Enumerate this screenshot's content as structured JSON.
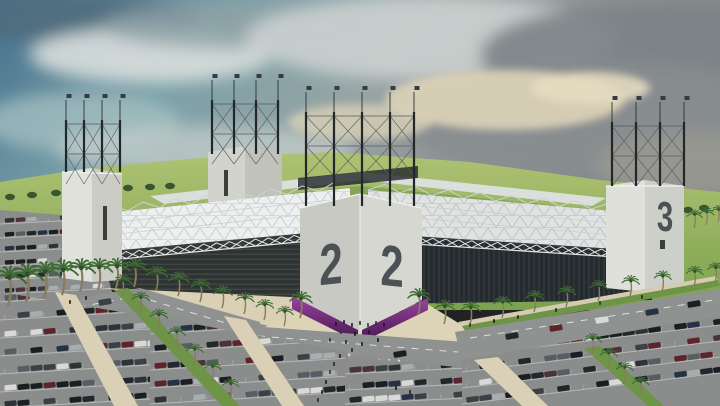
{
  "meta": {
    "description": "3D architectural rendering of a football stadium: white corner towers with large painted numbers, steel truss roofs, dark louvered facades, purple entrance glazing, palm-lined roads and full parking lots under a partly cloudy sky",
    "width": 720,
    "height": 406
  },
  "stadium": {
    "towers": {
      "south": {
        "name": "front corner tower",
        "faces": [
          {
            "label": "2"
          },
          {
            "label": "2"
          }
        ]
      },
      "east": {
        "name": "right corner tower",
        "faces": [
          {
            "label": "3"
          }
        ]
      },
      "west": {
        "name": "left corner tower"
      },
      "north": {
        "name": "rear corner tower"
      }
    }
  },
  "palette": {
    "sky_top": "#4b7b93",
    "sky_mid": "#79a0a9",
    "sky_right": "#7e8486",
    "cloud_light": "#d9dcd9",
    "cloud_grey": "#85898c",
    "cloud_cream": "#ddd2b4",
    "grass": "#9cb868",
    "grass_dark": "#7ba24e",
    "roof": "#eef0f0",
    "truss": "#c2c8c9",
    "facade_west": "#2e3432",
    "facade_east": "#242a2d",
    "tower_light": "#dcddd7",
    "tower_mid": "#cbccc5",
    "number": "#4b5154",
    "purple": "#8d3c90",
    "purple_dark": "#46164e",
    "asphalt": "#8a8d8b",
    "road": "#8f9290",
    "plaza": "#d9d0b5",
    "median_green": "#6d9447",
    "palm_green": "#3e6b33",
    "palm_trunk": "#8a7a5e",
    "mast": "#23272a",
    "flag": "#343b42",
    "car_colors": [
      "#1b1e22",
      "#23272b",
      "#1b1e22",
      "#2e3338",
      "#3a4046",
      "#565d63",
      "#a8adb0",
      "#d9dad8",
      "#5e242b",
      "#263244",
      "#23272b",
      "#4b3138"
    ],
    "people": [
      "#16191d",
      "#242019",
      "#2b3036",
      "#101418"
    ]
  }
}
